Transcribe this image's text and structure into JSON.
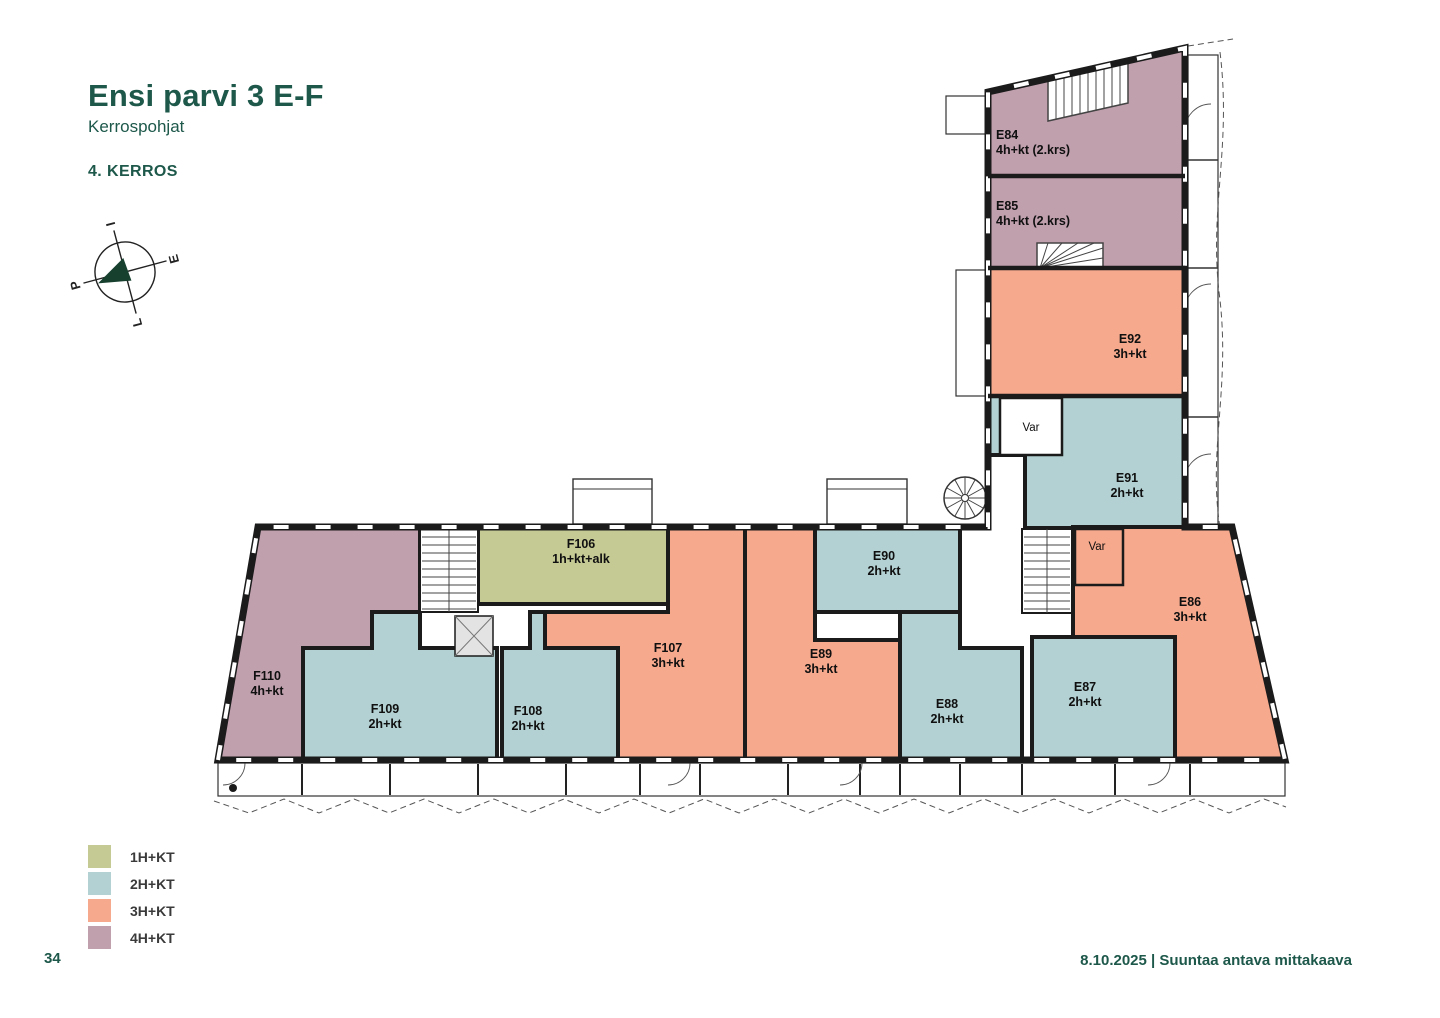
{
  "page": {
    "title": "Ensi parvi 3 E-F",
    "subtitle": "Kerrospohjat",
    "floor_label": "4. KERROS",
    "page_number": "34",
    "footer": "8.10.2025 | Suuntaa antava mittakaava"
  },
  "compass": {
    "top": "I",
    "right": "E",
    "bottom": "L",
    "left": "P"
  },
  "legend": {
    "items": [
      {
        "label": "1H+KT",
        "color": "#c5c993"
      },
      {
        "label": "2H+KT",
        "color": "#b3d1d2"
      },
      {
        "label": "3H+KT",
        "color": "#f6a98d"
      },
      {
        "label": "4H+KT",
        "color": "#c1a0ae"
      }
    ]
  },
  "apartments": [
    {
      "id": "E84",
      "type": "4h+kt (2.krs)"
    },
    {
      "id": "E85",
      "type": "4h+kt (2.krs)"
    },
    {
      "id": "E92",
      "type": "3h+kt"
    },
    {
      "id": "E91",
      "type": "2h+kt"
    },
    {
      "id": "E90",
      "type": "2h+kt"
    },
    {
      "id": "E89",
      "type": "3h+kt"
    },
    {
      "id": "E88",
      "type": "2h+kt"
    },
    {
      "id": "E87",
      "type": "2h+kt"
    },
    {
      "id": "E86",
      "type": "3h+kt"
    },
    {
      "id": "F106",
      "type": "1h+kt+alk"
    },
    {
      "id": "F107",
      "type": "3h+kt"
    },
    {
      "id": "F108",
      "type": "2h+kt"
    },
    {
      "id": "F109",
      "type": "2h+kt"
    },
    {
      "id": "F110",
      "type": "4h+kt"
    }
  ],
  "plan": {
    "storage_label": "Var"
  }
}
